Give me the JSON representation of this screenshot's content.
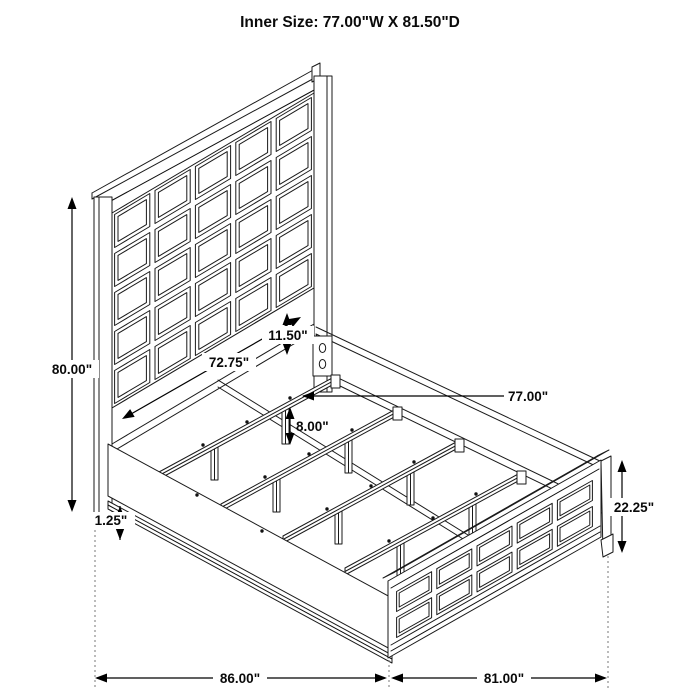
{
  "title": "Inner Size: 77.00\"W X 81.50\"D",
  "diagram": {
    "subject": "panel-bed-frame-dimension-drawing",
    "line_color": "#1a1a1a",
    "background": "#ffffff",
    "headboard_grid": {
      "columns": 5,
      "rows": 5
    },
    "footboard_grid": {
      "columns": 5,
      "rows": 2
    },
    "slat_count": 4
  },
  "dims": {
    "overall_height": "80.00\"",
    "rail_to_panel": "11.50\"",
    "headboard_inner_width": "72.75\"",
    "slat_length": "77.00\"",
    "slat_leg_height": "8.00\"",
    "rail_trim_height": "1.25\"",
    "footboard_height": "22.25\"",
    "overall_depth": "86.00\"",
    "footboard_width": "81.00\""
  }
}
